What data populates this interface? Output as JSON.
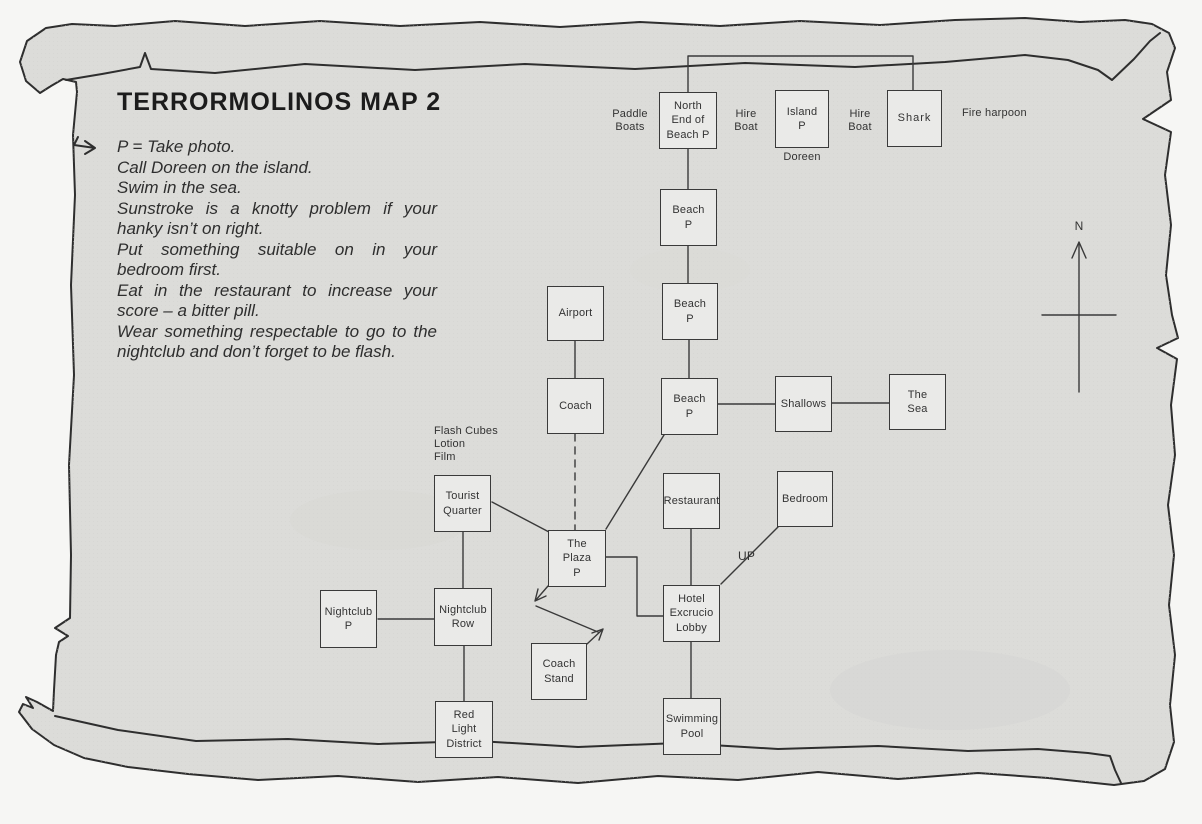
{
  "title": "TERRORMOLINOS MAP 2",
  "instructions": [
    "P = Take photo.",
    "Call Doreen on the island.",
    "Swim in the sea.",
    "Sunstroke is a knotty problem if your hanky isn’t on right.",
    "Put something suitable on in your bedroom first.",
    "Eat in the restaurant to increase your score – a bitter pill.",
    "Wear something respectable to go to the nightclub and don’t forget to be flash."
  ],
  "nodes": {
    "north_end_beach": {
      "label": "North\nEnd of\nBeach P"
    },
    "island": {
      "label": "Island\nP"
    },
    "shark": {
      "label": "Shark"
    },
    "beach1": {
      "label": "Beach\nP"
    },
    "beach2": {
      "label": "Beach\nP"
    },
    "beach3": {
      "label": "Beach\nP"
    },
    "airport": {
      "label": "Airport"
    },
    "coach": {
      "label": "Coach"
    },
    "shallows": {
      "label": "Shallows"
    },
    "the_sea": {
      "label": "The\nSea"
    },
    "tourist_quarter": {
      "label": "Tourist\nQuarter"
    },
    "plaza": {
      "label": "The\nPlaza\nP"
    },
    "restaurant": {
      "label": "Restaurant"
    },
    "bedroom": {
      "label": "Bedroom"
    },
    "hotel": {
      "label": "Hotel\nExcrucio\nLobby"
    },
    "nightclub_p": {
      "label": "Nightclub\nP"
    },
    "nightclub_row": {
      "label": "Nightclub\nRow"
    },
    "coach_stand": {
      "label": "Coach\nStand"
    },
    "red_light": {
      "label": "Red\nLight\nDistrict"
    },
    "swimming_pool": {
      "label": "Swimming\nPool"
    }
  },
  "annotations": {
    "paddle_boats": "Paddle\nBoats",
    "hire_boat_1": "Hire\nBoat",
    "hire_boat_2": "Hire\nBoat",
    "fire_harpoon": "Fire harpoon",
    "doreen": "Doreen",
    "flash_cubes": "Flash Cubes\nLotion\nFilm",
    "up": "UP",
    "north": "N"
  },
  "colors": {
    "paper": "#dcdcd9",
    "background": "#f6f6f4",
    "ink": "#2f2f2f",
    "box_fill": "#eaeae8"
  }
}
